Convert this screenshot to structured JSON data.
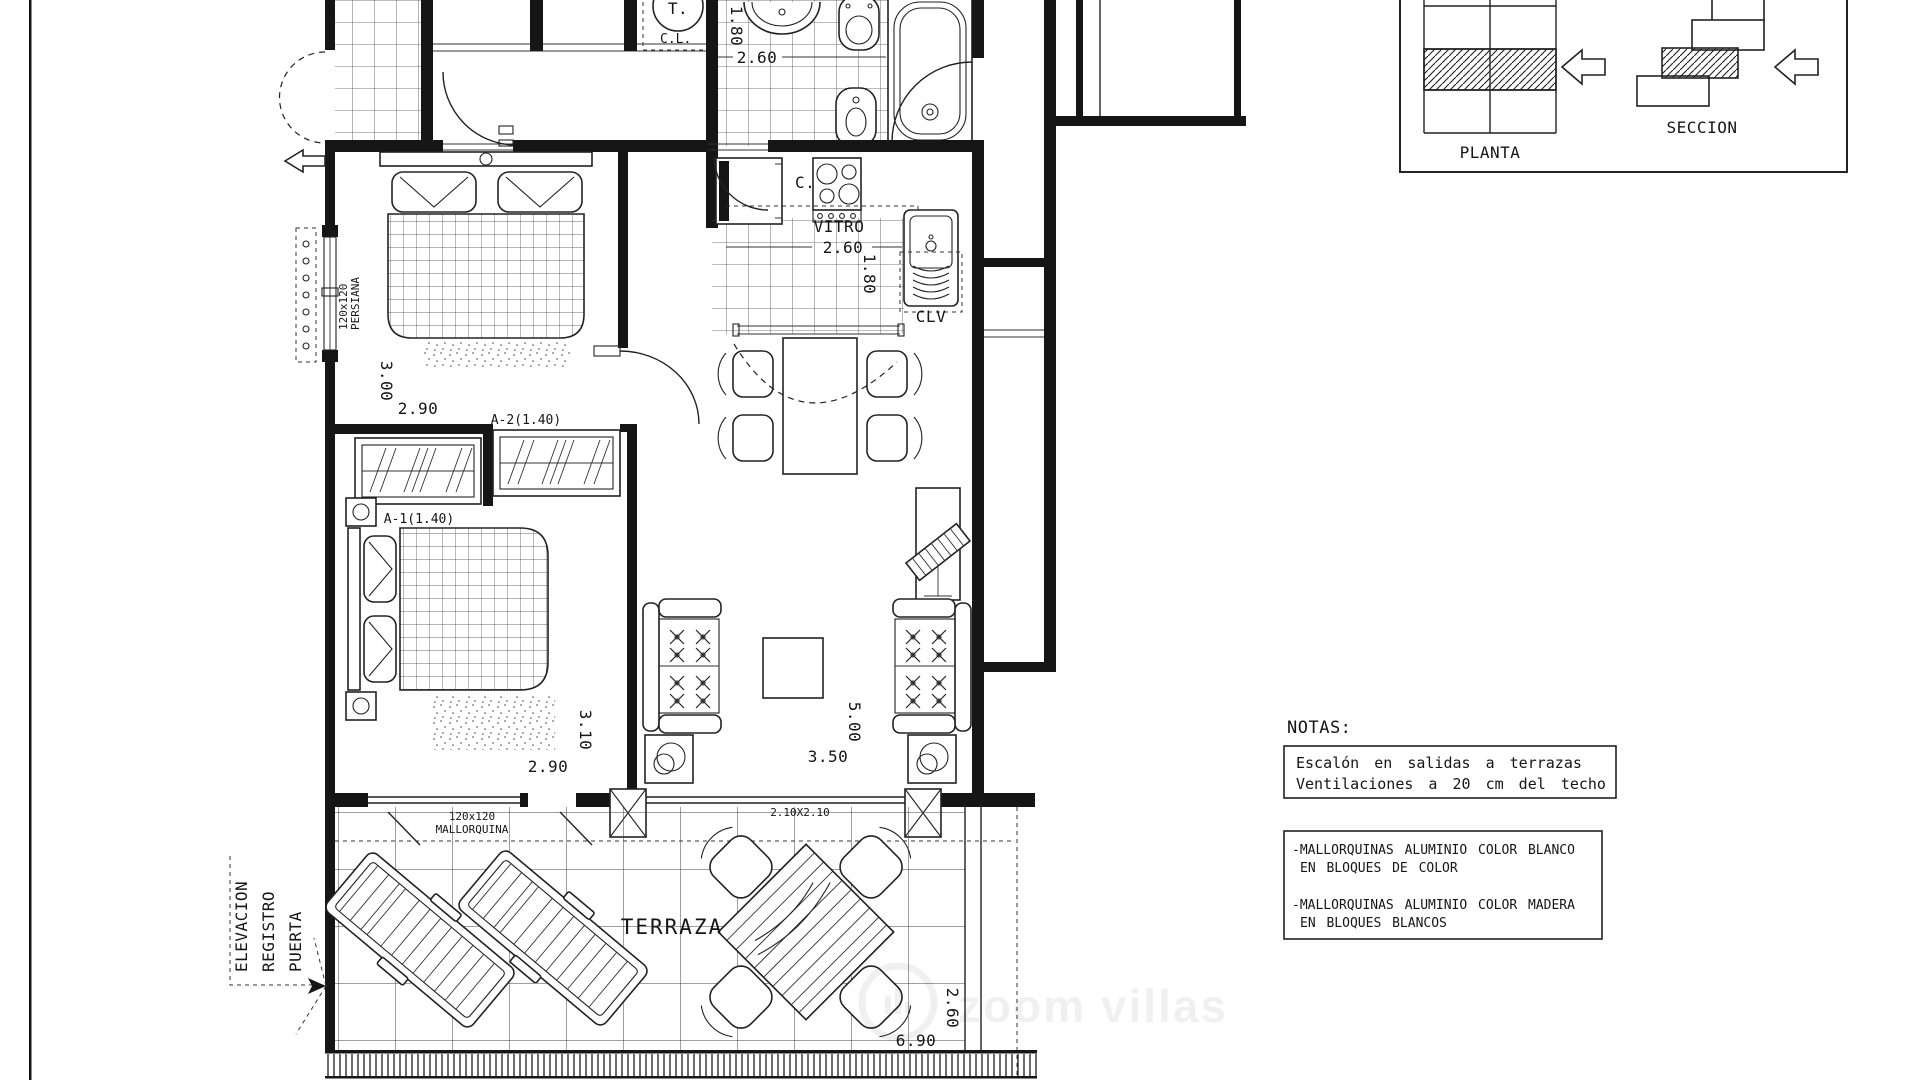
{
  "legend": {
    "planta": "PLANTA",
    "seccion": "SECCION"
  },
  "notas": {
    "title": "NOTAS:",
    "escalon_line1": "Escalón en salidas a terrazas",
    "escalon_line2": "Ventilaciones a 20 cm del techo",
    "mallorquinas_blanco_line1": "-MALLORQUINAS ALUMINIO COLOR BLANCO",
    "mallorquinas_blanco_line2": "EN BLOQUES DE COLOR",
    "mallorquinas_madera_line1": "-MALLORQUINAS ALUMINIO COLOR MADERA",
    "mallorquinas_madera_line2": "EN BLOQUES BLANCOS"
  },
  "plan": {
    "rooms": {
      "terraza": "TERRAZA"
    },
    "labels": {
      "vitro": "VITRO",
      "clv": "CLV",
      "c": "C.",
      "t": "T.",
      "cl": "C.L.",
      "a1": "A-1(1.40)",
      "a2": "A-2(1.40)",
      "mallorquina1": "120x120",
      "mallorquina2": "MALLORQUINA",
      "persiana1": "120x120",
      "persiana2": "PERSIANA",
      "window210": "2.10X2.10",
      "elev1": "ELEVACION",
      "elev2": "REGISTRO",
      "elev3": "PUERTA"
    },
    "dims": {
      "bath_h": "1.80",
      "bath_w": "2.60",
      "kitchen_w": "2.60",
      "kitchen_h": "1.80",
      "bed1_h": "3.00",
      "bed1_w": "2.90",
      "bed2_h": "3.10",
      "bed2_w": "2.90",
      "living_h": "5.00",
      "living_w": "3.50",
      "terrace_h": "2.60",
      "terrace_w": "6.90"
    }
  },
  "watermark": {
    "brand": "zoom villas"
  },
  "colors": {
    "ink": "#161616",
    "paper": "#ffffff"
  }
}
